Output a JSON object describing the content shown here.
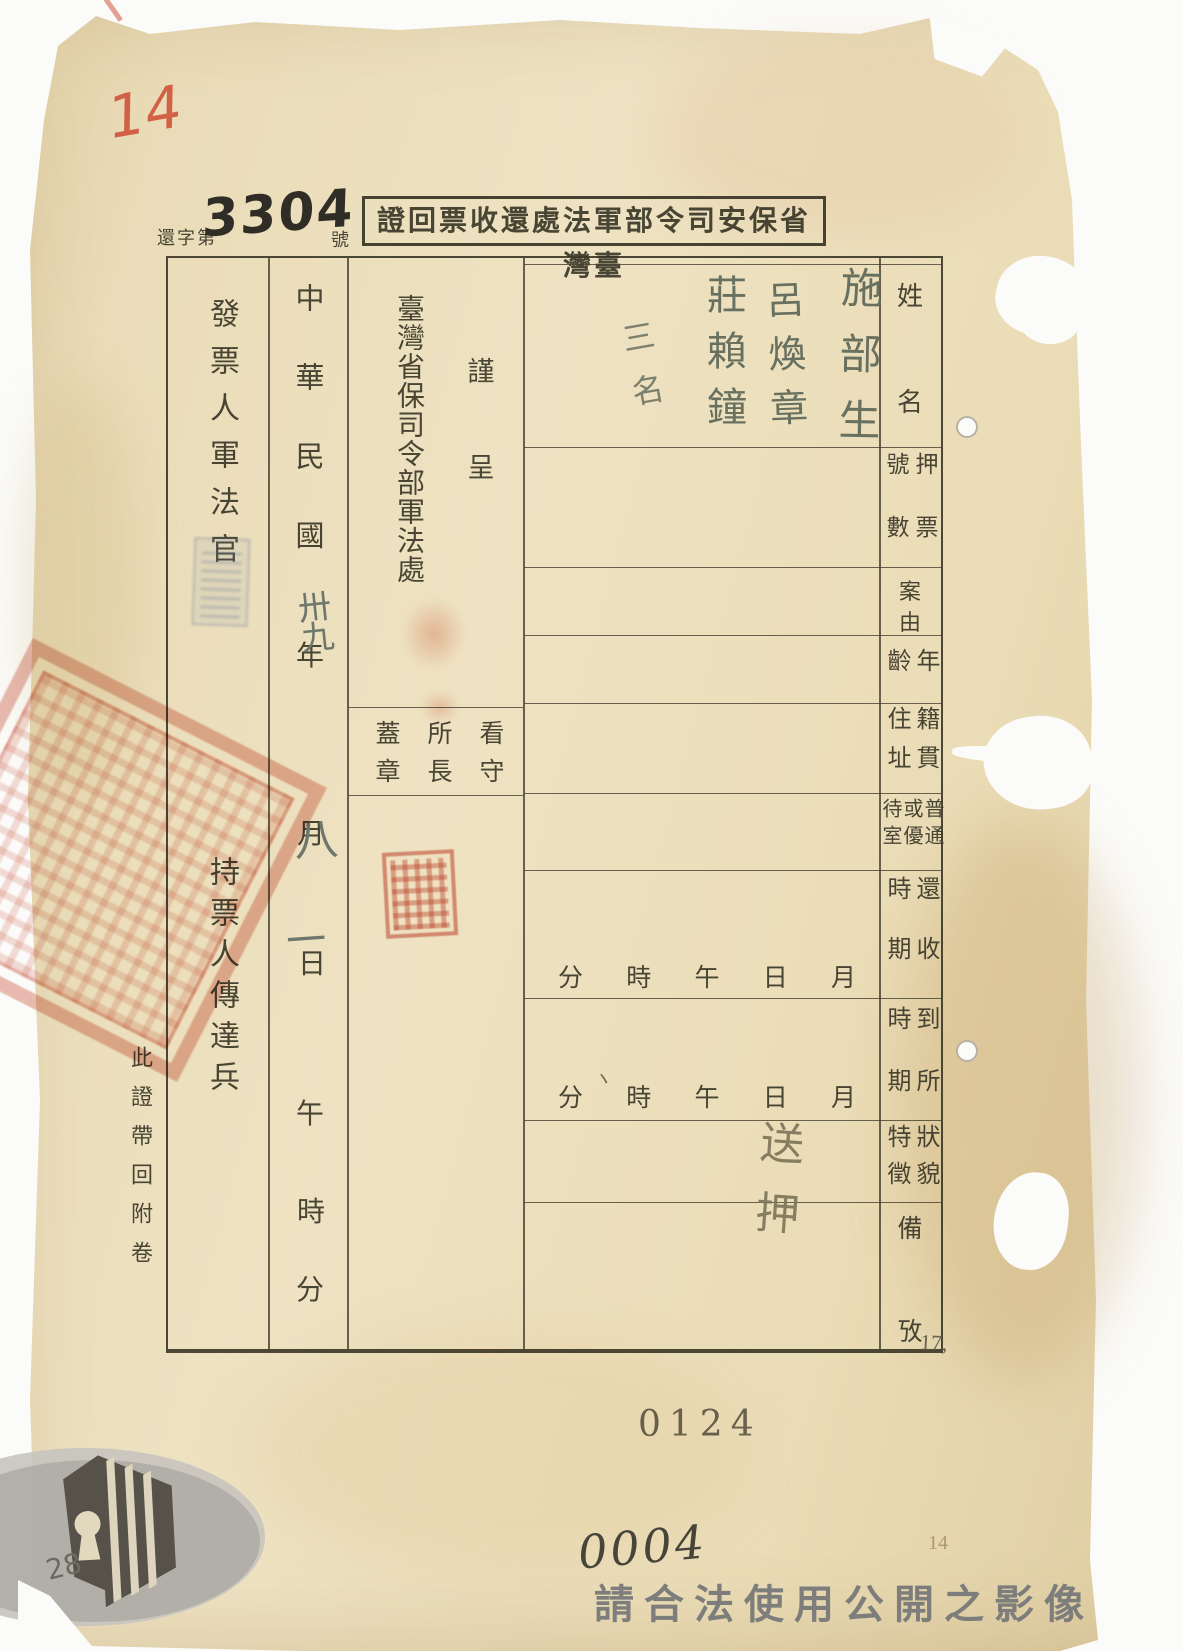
{
  "colors": {
    "paper": "#eadcb8",
    "ink": "#403c2b",
    "seal_red": "#cf5a42",
    "handwriting_gray": "#68705f",
    "watermark_gray": "#7d7d7b",
    "backdrop": "#fbfbf9"
  },
  "header": {
    "serial_prefix": "還字第",
    "serial_number": "3304",
    "serial_suffix": "號",
    "title": "臺灣省保安司令部軍法處還收票回證",
    "title_display": "證回票收還處法軍部令司安保省灣臺"
  },
  "table": {
    "row_labels": [
      {
        "text": "姓名",
        "display": "姓\n名"
      },
      {
        "text": "押票號數",
        "display": "押票\n號數"
      },
      {
        "text": "案由",
        "display": "案\n由"
      },
      {
        "text": "年齡",
        "display": "年\n齡"
      },
      {
        "text": "籍貫住址",
        "display": "籍貫\n住址"
      },
      {
        "text": "普通或優待室",
        "display": "普通\n或優\n待室"
      },
      {
        "text": "還收時期",
        "display": "還收\n時期"
      },
      {
        "text": "到所時期",
        "display": "到所\n時期"
      },
      {
        "text": "狀貌特徵",
        "display": "狀貌\n特徵"
      },
      {
        "text": "備攷",
        "display": "備\n攷"
      }
    ],
    "time_chars": [
      "分",
      "時",
      "午",
      "日",
      "月"
    ]
  },
  "left_section": {
    "submit": "謹呈",
    "submit_display": "謹\n呈",
    "office": "臺灣省保司令部軍法處",
    "warden_seal": "看守所長蓋章",
    "warden_seal_display": "看守\n所長\n蓋章",
    "issuer": "發票人軍法官",
    "bearer": "持票人傳達兵",
    "attach_note": "此證帶回附卷"
  },
  "date": {
    "era": "中華民國",
    "year_label": "年",
    "month_label": "月",
    "day_label": "日",
    "noon_label": "午",
    "hour_label": "時",
    "minute_label": "分",
    "year_value": "卅九",
    "month_value": "八",
    "day_value": "一"
  },
  "entries": {
    "names": [
      "施部生",
      "呂煥章",
      "莊賴鐘"
    ],
    "names_note": "三名",
    "remark": "送押",
    "tick": "丶"
  },
  "footer": {
    "stamp_number": "0124",
    "hand_number": "0004",
    "watermark": "請合法使用公開之影像"
  },
  "margin_notes": {
    "red_note": "14",
    "right_mid": "17,",
    "right_bottom": "14",
    "bottom_left": "28"
  }
}
